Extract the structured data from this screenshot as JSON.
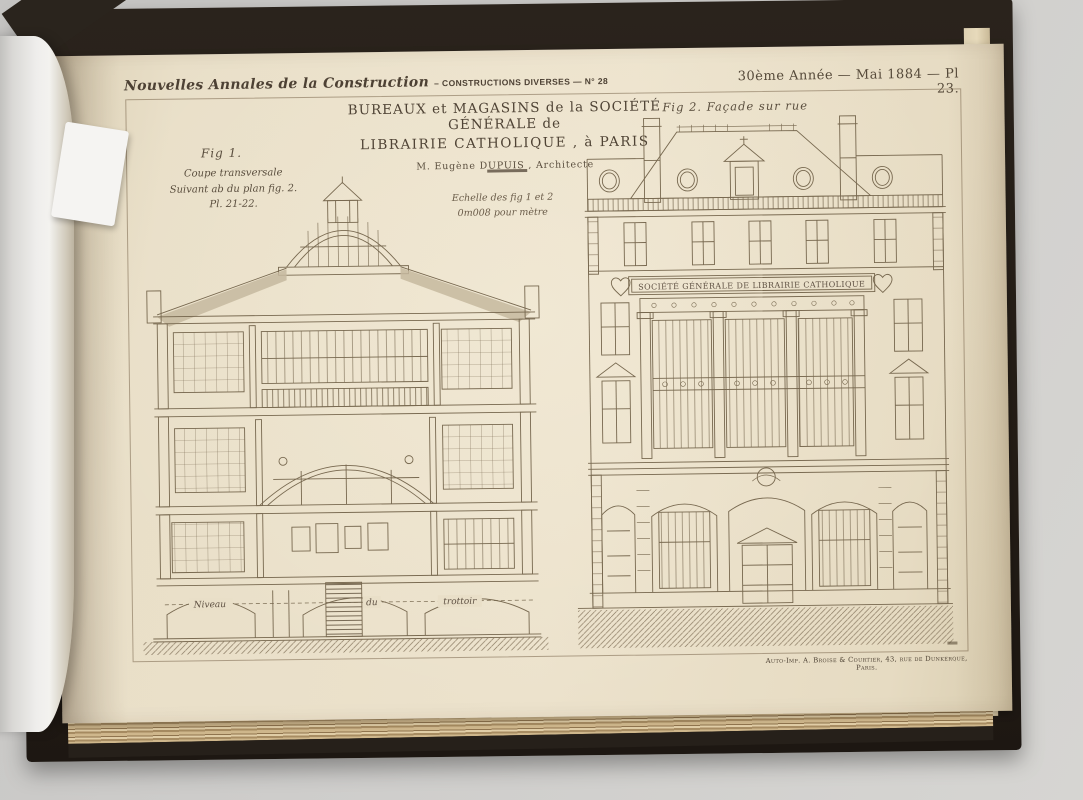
{
  "photo": {
    "desk_color": "#cecdcb",
    "book_cover_color": "#241d16",
    "paper_color": "#e9dfc8",
    "ink_color": "#5f5143"
  },
  "page_header": {
    "journal_title": "Nouvelles Annales de la Construction",
    "journal_subtitle": "– CONSTRUCTIONS DIVERSES — N° 28",
    "issue_info": "30ème Année — Mai 1884 — Pl 23."
  },
  "plate": {
    "title_line1": "BUREAUX et MAGASINS de la SOCIÉTÉ GÉNÉRALE de",
    "title_line2": "LIBRAIRIE CATHOLIQUE , à PARIS",
    "architect": "M. Eugène DUPUIS , Architecte",
    "scale_line1": "Echelle des fig 1 et 2",
    "scale_line2": "0m008 pour mètre",
    "fig1": {
      "label": "Fig 1.",
      "caption_line1": "Coupe transversale",
      "caption_line2": "Suivant ab du plan fig. 2.",
      "caption_line3": "Pl. 21-22.",
      "annotation_niveau": "Niveau",
      "annotation_du": "du",
      "annotation_trottoir": "trottoir"
    },
    "fig2": {
      "label": "Fig 2. Façade sur rue",
      "building_sign": "SOCIÉTÉ GÉNÉRALE DE LIBRAIRIE CATHOLIQUE"
    },
    "imprint": "Auto-Imp. A. Broise & Courtier, 43, rue de Dunkerque, Paris."
  }
}
